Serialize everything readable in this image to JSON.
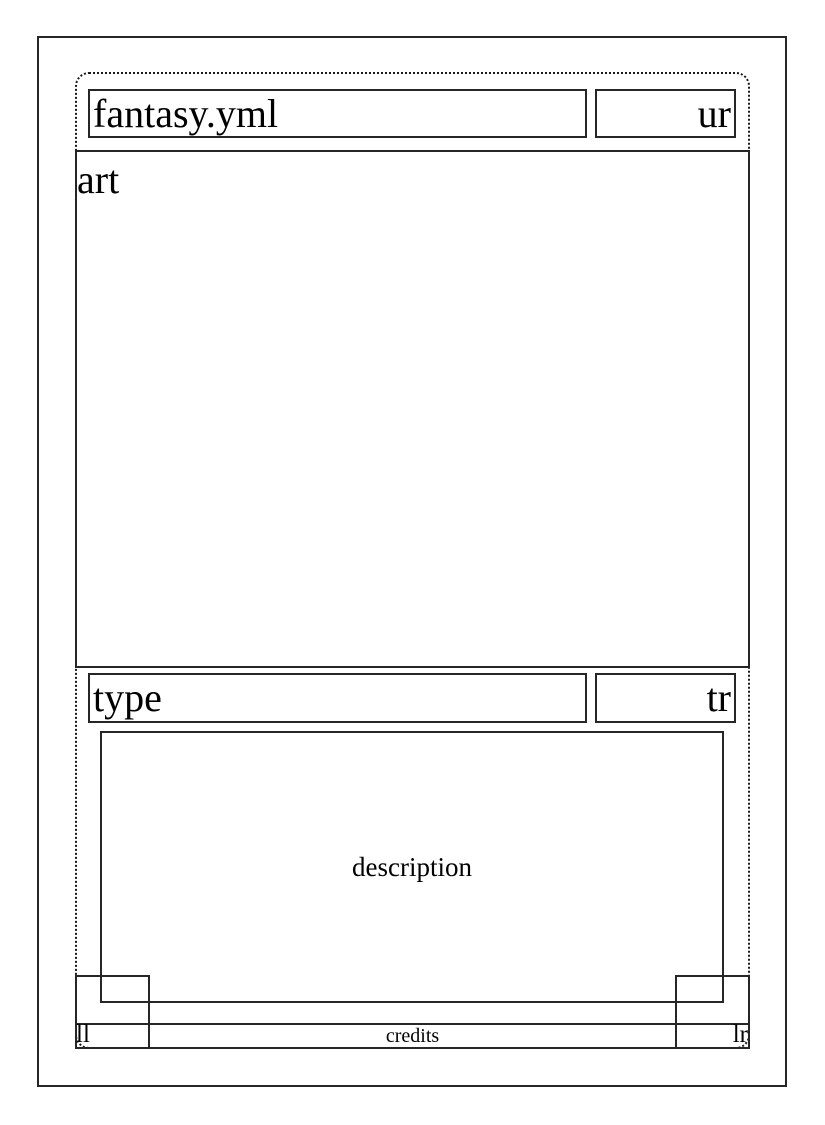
{
  "card_template": {
    "file_label": "fantasy.yml",
    "fields": {
      "upper_right": "ur",
      "art": "art",
      "type": "type",
      "type_right": "tr",
      "description": "description",
      "lower_left": "ll",
      "credits": "credits",
      "lower_right": "lr"
    }
  },
  "colors": {
    "line": "#262626",
    "text": "#000000",
    "background": "#ffffff"
  }
}
